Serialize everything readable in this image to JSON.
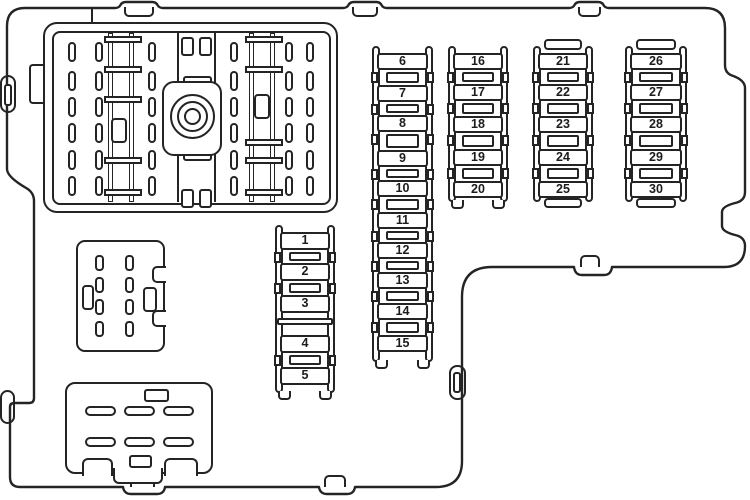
{
  "diagram": {
    "fuse_columns": [
      {
        "name": "fuses-1-5",
        "fuses": [
          "1",
          "2",
          "3",
          "4",
          "5"
        ]
      },
      {
        "name": "fuses-6-15",
        "fuses": [
          "6",
          "7",
          "8",
          "9",
          "10",
          "11",
          "12",
          "13",
          "14",
          "15"
        ]
      },
      {
        "name": "fuses-16-20",
        "fuses": [
          "16",
          "17",
          "18",
          "19",
          "20"
        ]
      },
      {
        "name": "fuses-21-25",
        "fuses": [
          "21",
          "22",
          "23",
          "24",
          "25"
        ]
      },
      {
        "name": "fuses-26-30",
        "fuses": [
          "26",
          "27",
          "28",
          "29",
          "30"
        ]
      }
    ],
    "colors": {
      "line": "#242424",
      "background": "#ffffff",
      "fuse_text": "#1c1c1c"
    }
  }
}
